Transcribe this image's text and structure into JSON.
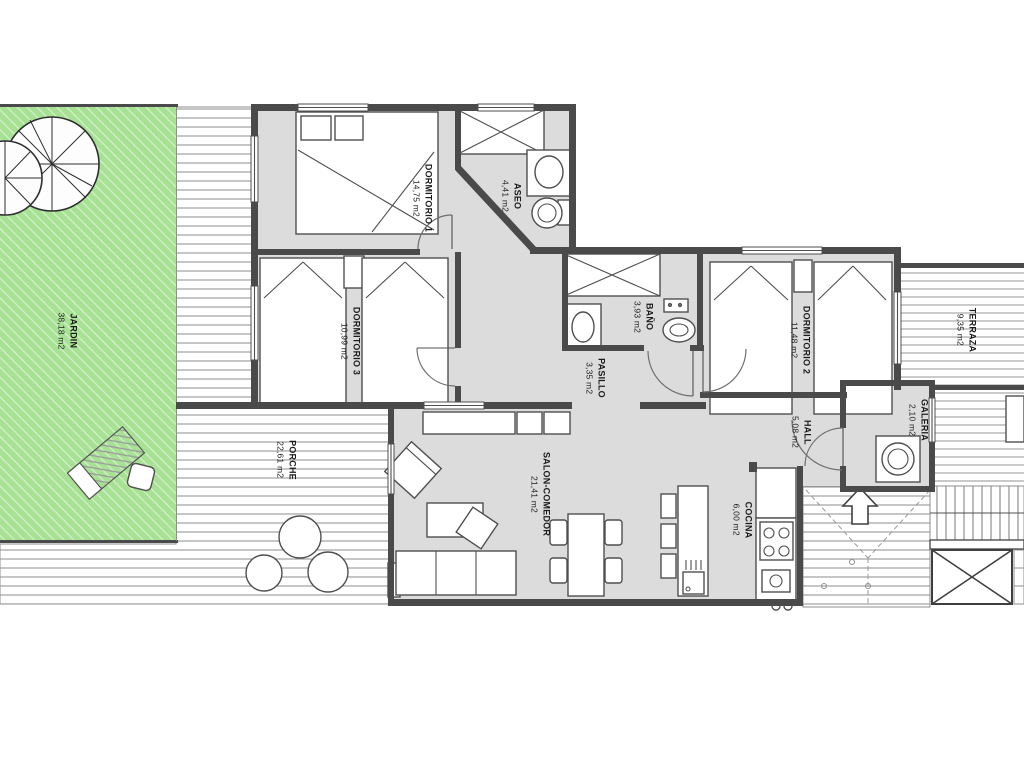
{
  "colors": {
    "garden": "#a7e194",
    "room": "#dcdcdc",
    "wall": "#4a4a4a",
    "line": "#4f4f4f",
    "background": "#ffffff"
  },
  "rooms": [
    {
      "id": "jardin",
      "name": "JARDIN",
      "area": "38,18 m2"
    },
    {
      "id": "porche",
      "name": "PORCHE",
      "area": "22,61 m2"
    },
    {
      "id": "dormitorio1",
      "name": "DORMITORIO 1",
      "area": "14,75 m2"
    },
    {
      "id": "aseo",
      "name": "ASEO",
      "area": "4,41 m2"
    },
    {
      "id": "dormitorio3",
      "name": "DORMITORIO 3",
      "area": "10,99 m2"
    },
    {
      "id": "pasillo",
      "name": "PASILLO",
      "area": "3,35 m2"
    },
    {
      "id": "bano",
      "name": "BAÑO",
      "area": "3,93 m2"
    },
    {
      "id": "dormitorio2",
      "name": "DORMITORIO 2",
      "area": "11,48 m2"
    },
    {
      "id": "terraza",
      "name": "TERRAZA",
      "area": "9,35 m2"
    },
    {
      "id": "galeria",
      "name": "GALERIA",
      "area": "2,10 m2"
    },
    {
      "id": "hall",
      "name": "HALL",
      "area": "5,08 m2"
    },
    {
      "id": "salon",
      "name": "SALON-COMEDOR",
      "area": "21,41 m2"
    },
    {
      "id": "cocina",
      "name": "COCINA",
      "area": "6,00 m2"
    }
  ]
}
